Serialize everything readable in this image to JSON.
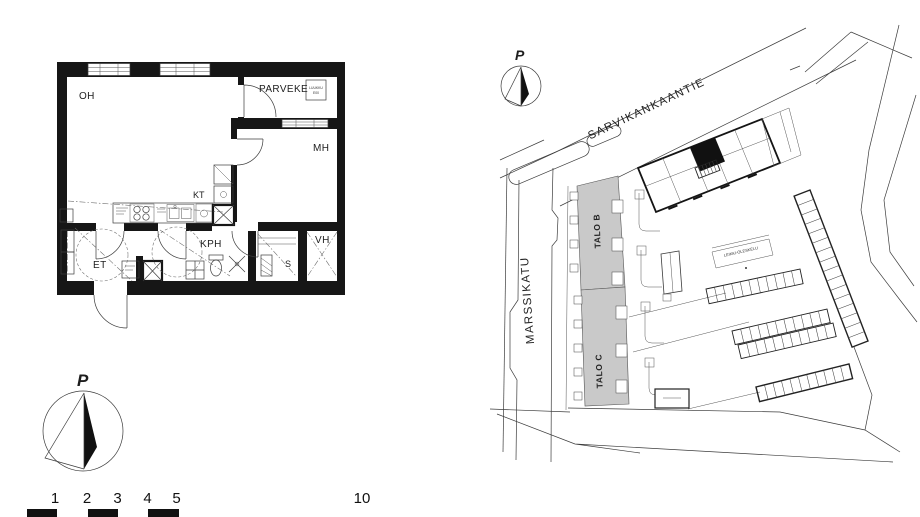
{
  "floorplan": {
    "rooms": {
      "oh": "OH",
      "parveke": "PARVEKE",
      "mh": "MH",
      "kt": "KT",
      "kph": "KPH",
      "et": "ET",
      "s": "S",
      "vh": "VH"
    },
    "hatch_box": {
      "line1": "LUUKKU",
      "line2": "E00"
    }
  },
  "siteplan": {
    "north_label": "P",
    "streets": {
      "sarvikankaantie": "SARVIKANKAANTIE",
      "marssikatu": "MARSSIKATU"
    },
    "buildings": {
      "talo_b": "TALO B",
      "talo_c": "TALO C"
    },
    "areas": {
      "leikki_oleskelu": "LEIKKI-OLESKELU"
    }
  },
  "compass": {
    "north_label": "P"
  },
  "scalebar": {
    "ticks": [
      "1",
      "2",
      "3",
      "4",
      "5"
    ],
    "far_tick": "10"
  },
  "colors": {
    "ink": "#161616",
    "building_fill": "#c9c9c9",
    "line": "#3c3c3c"
  }
}
